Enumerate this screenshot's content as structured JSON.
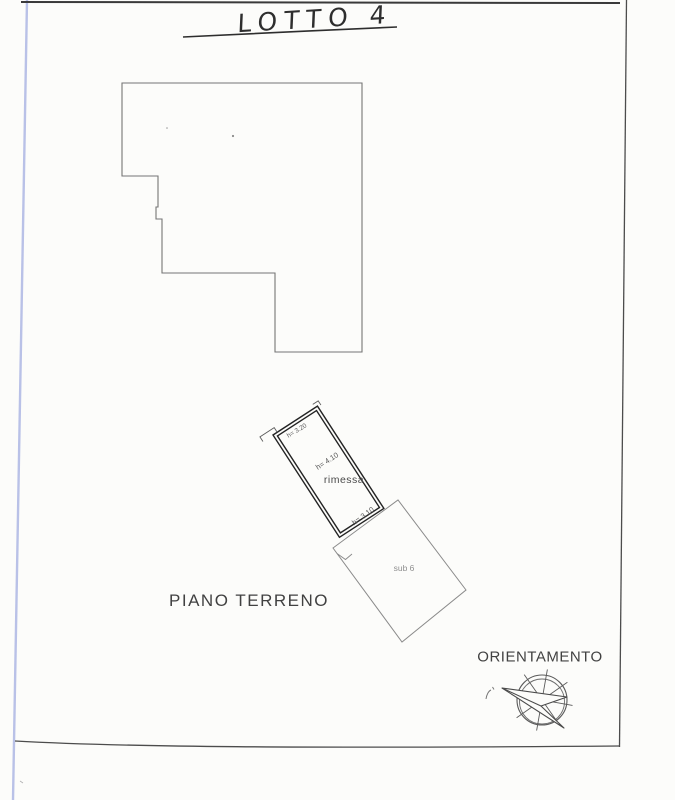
{
  "title": {
    "text": "LOTTO 4"
  },
  "labels": {
    "floor": "PIANO TERRENO",
    "orientation": "ORIENTAMENTO"
  },
  "structure": {
    "room": "rimessa",
    "sub_unit": "sub 6",
    "height_top": "h= 3.20",
    "height_room": "h= 4.10",
    "height_lower": "h= 3.10"
  },
  "icons": {
    "compass": "compass-rose-icon"
  },
  "colors": {
    "paper": "#fcfcfa",
    "ink": "#2e2e2e",
    "outline_gray": "#757575",
    "sub_gray": "#8a8a8a",
    "scan_edge_blue": "#b9c1e7"
  }
}
